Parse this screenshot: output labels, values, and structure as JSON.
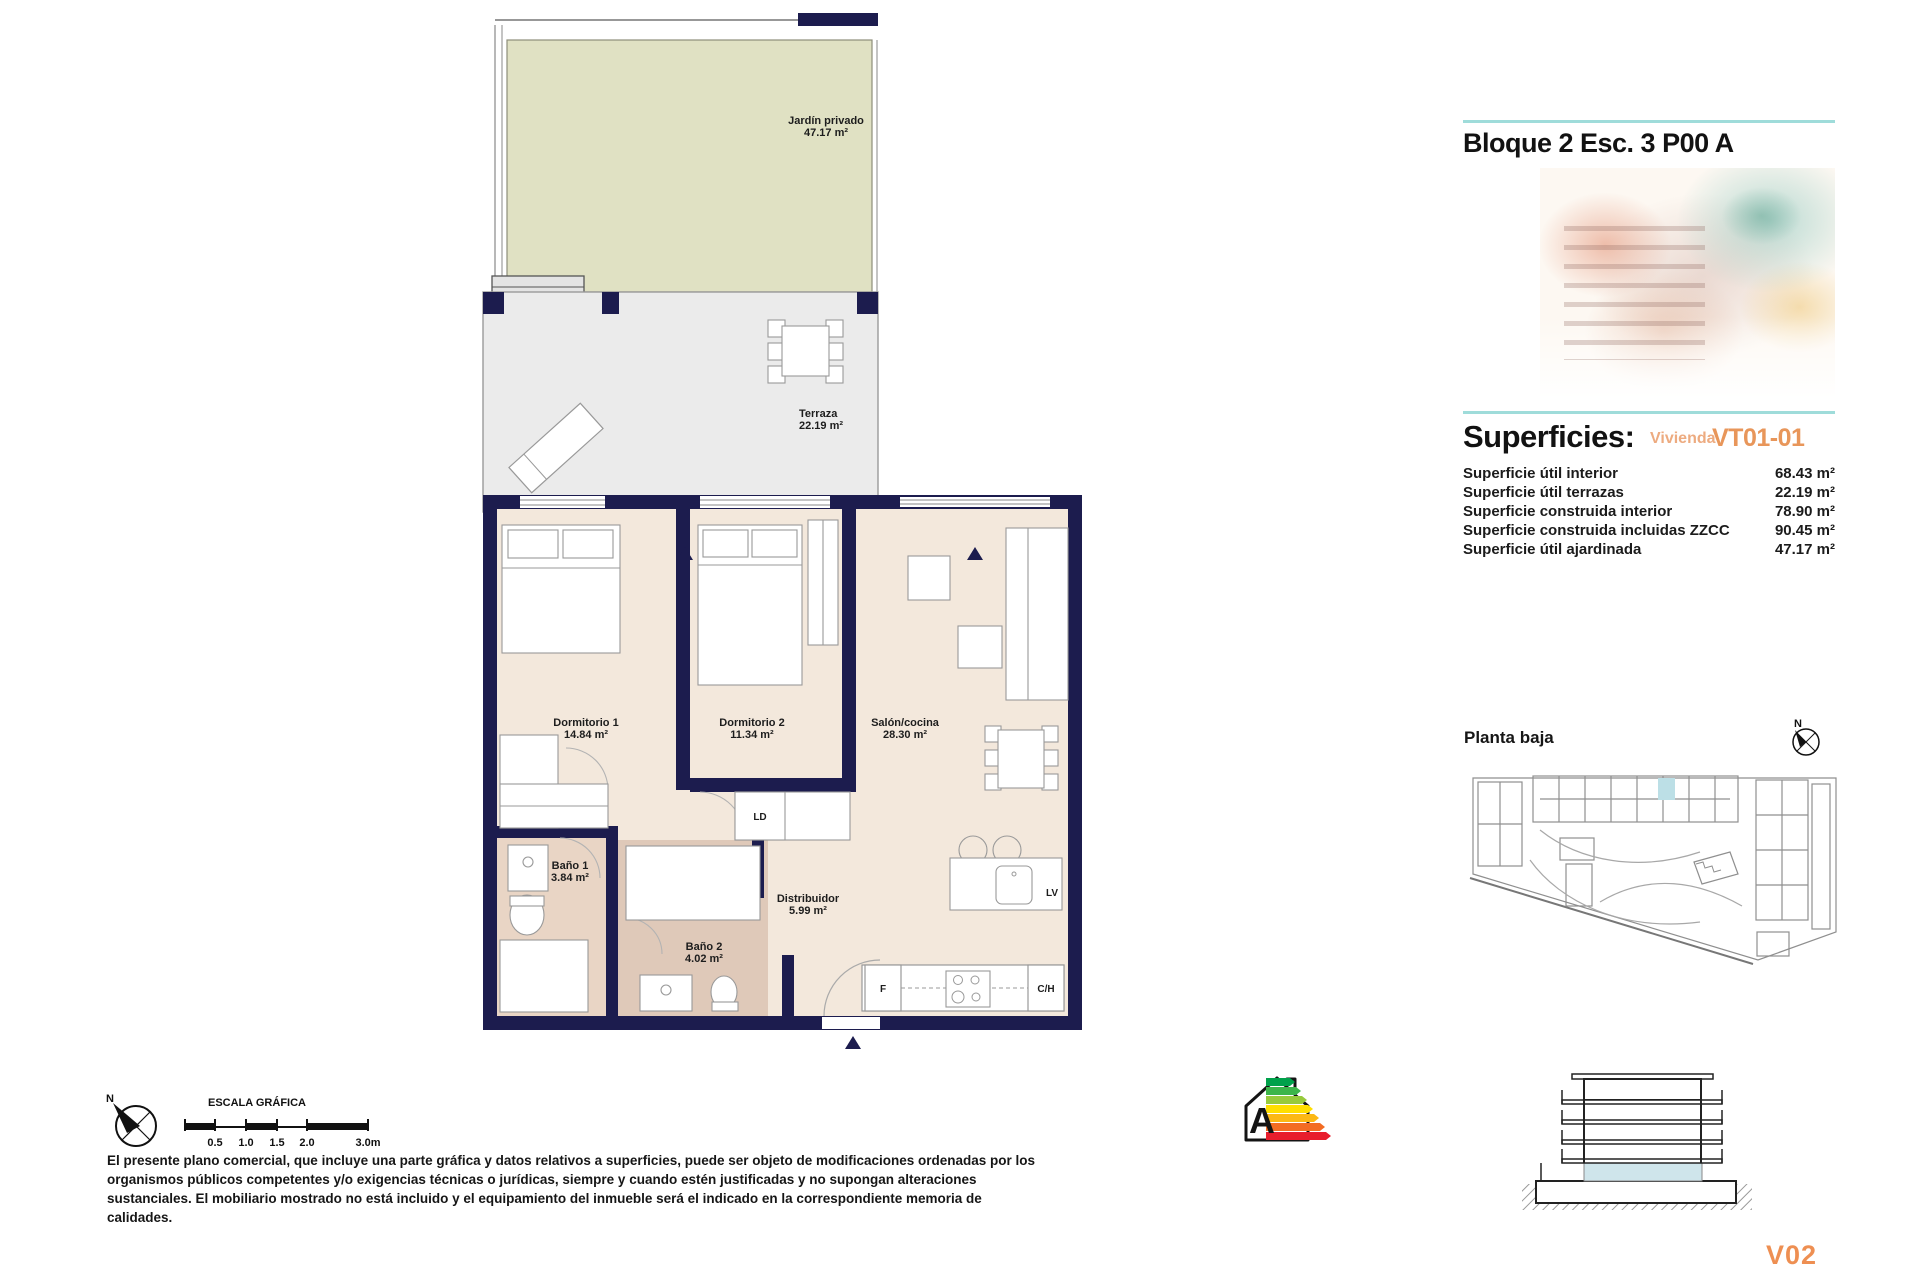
{
  "header": {
    "block_title": "Bloque 2 Esc. 3 P00 A"
  },
  "superficies": {
    "heading": "Superficies:",
    "vivienda_label": "Vivienda",
    "vivienda_code": "VT01-01",
    "rows": [
      {
        "label": "Superficie útil interior",
        "value": "68.43 m²"
      },
      {
        "label": "Superficie útil terrazas",
        "value": "22.19 m²"
      },
      {
        "label": "Superficie construida interior",
        "value": "78.90 m²"
      },
      {
        "label": "Superficie construida incluidas ZZCC",
        "value": "90.45 m²"
      },
      {
        "label": "Superficie útil ajardinada",
        "value": "47.17 m²"
      }
    ]
  },
  "floor_plan": {
    "rooms": [
      {
        "name": "Jardín privado",
        "area": "47.17 m²"
      },
      {
        "name": "Terraza",
        "area": "22.19 m²"
      },
      {
        "name": "Dormitorio 1",
        "area": "14.84 m²"
      },
      {
        "name": "Dormitorio 2",
        "area": "11.34 m²"
      },
      {
        "name": "Salón/cocina",
        "area": "28.30 m²"
      },
      {
        "name": "Baño 1",
        "area": "3.84 m²"
      },
      {
        "name": "Baño 2",
        "area": "4.02 m²"
      },
      {
        "name": "Distribuidor",
        "area": "5.99 m²"
      }
    ],
    "appliances": {
      "ld": "LD",
      "lv": "LV",
      "f": "F",
      "ch": "C/H"
    }
  },
  "site_plan": {
    "label": "Planta baja",
    "north_label": "N"
  },
  "scale_bar": {
    "title": "ESCALA GRÁFICA",
    "ticks": [
      "0.5",
      "1.0",
      "1.5",
      "2.0",
      "3.0m"
    ],
    "north_label": "N"
  },
  "disclaimer": "El presente plano comercial, que incluye una parte gráfica y datos relativos a superficies, puede ser objeto de modificaciones ordenadas por los organismos públicos competentes y/o exigencias técnicas o jurídicas, siempre y cuando estén justificadas y no supongan alteraciones sustanciales. El mobiliario mostrado no está incluido y el equipamiento del inmueble será el indicado en la correspondiente memoria de calidades.",
  "energy_rating": {
    "letter": "A"
  },
  "version_code": "V02",
  "colors": {
    "wall_navy": "#1c1c4e",
    "garden_green": "#e0e1c3",
    "terrace_gray": "#ebebeb",
    "floor_beige": "#f3e8dc",
    "bath_beige": "#e9d5c5",
    "accent_orange": "#e8965a",
    "accent_teal": "#9fdcda",
    "highlight_blue": "#bcdfe6"
  }
}
